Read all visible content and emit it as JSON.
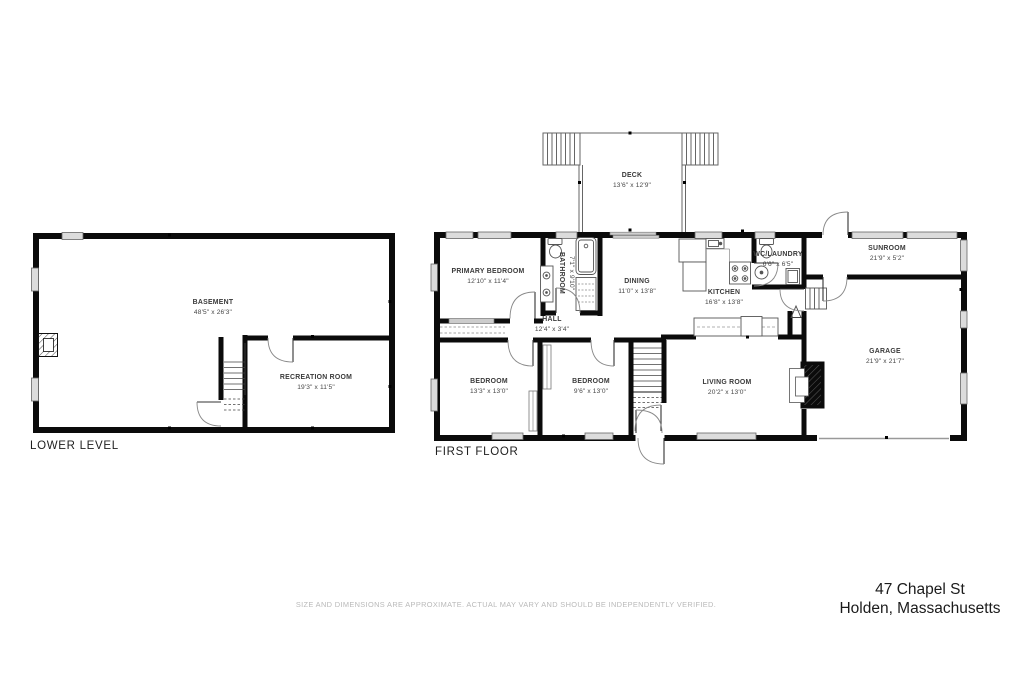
{
  "floors": {
    "lower": {
      "title": "LOWER LEVEL",
      "rooms": {
        "basement": {
          "name": "BASEMENT",
          "dims": "48'5\" x 26'3\""
        },
        "recreation": {
          "name": "RECREATION ROOM",
          "dims": "19'3\" x 11'5\""
        }
      }
    },
    "first": {
      "title": "FIRST FLOOR",
      "rooms": {
        "deck": {
          "name": "DECK",
          "dims": "13'6\" x 12'9\""
        },
        "primary_bedroom": {
          "name": "PRIMARY BEDROOM",
          "dims": "12'10\" x 11'4\""
        },
        "bathroom": {
          "name": "BATHROOM",
          "dims": "7'1\" x 9'10\""
        },
        "dining": {
          "name": "DINING",
          "dims": "11'0\" x 13'8\""
        },
        "kitchen": {
          "name": "KITCHEN",
          "dims": "16'8\" x 13'8\""
        },
        "wc_laundry": {
          "name": "WC/LAUNDRY",
          "dims": "6'6\" x 6'5\""
        },
        "sunroom": {
          "name": "SUNROOM",
          "dims": "21'9\" x 5'2\""
        },
        "hall": {
          "name": "HALL",
          "dims": "12'4\" x 3'4\""
        },
        "bedroom_a": {
          "name": "BEDROOM",
          "dims": "13'3\" x 13'0\""
        },
        "bedroom_b": {
          "name": "BEDROOM",
          "dims": "9'6\" x 13'0\""
        },
        "living_room": {
          "name": "LIVING ROOM",
          "dims": "20'2\" x 13'0\""
        },
        "garage": {
          "name": "GARAGE",
          "dims": "21'9\" x 21'7\""
        }
      }
    }
  },
  "footer": {
    "disclaimer": "SIZE AND DIMENSIONS ARE APPROXIMATE. ACTUAL MAY VARY AND SHOULD BE INDEPENDENTLY VERIFIED.",
    "address_line1": "47 Chapel St",
    "address_line2": "Holden, Massachusetts"
  },
  "colors": {
    "wall": "#0b0b0b",
    "window_fill": "#dcdcdc",
    "label_text": "#3a3a3a"
  }
}
